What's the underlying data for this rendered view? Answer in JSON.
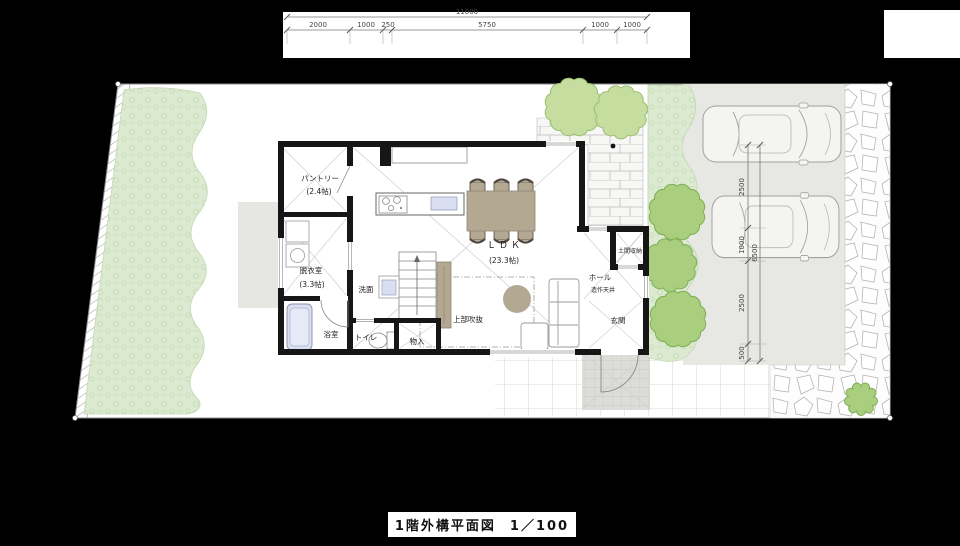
{
  "title": {
    "label": "1階外構平面図",
    "scale": "1／100"
  },
  "dims": {
    "top": {
      "total": "11000",
      "segments": [
        "2000",
        "1000",
        "250",
        "5750",
        "1000",
        "1000"
      ]
    },
    "right": {
      "total": "6500",
      "segments": [
        "2500",
        "1000",
        "2500",
        "500"
      ]
    }
  },
  "rooms": {
    "pantry": {
      "name": "パントリー",
      "size": "(2.4帖)"
    },
    "dressing_room": {
      "name": "脱衣室",
      "size": "(3.3帖)"
    },
    "washroom": {
      "name": "洗面"
    },
    "bathroom": {
      "name": "浴室"
    },
    "toilet": {
      "name": "トイレ"
    },
    "closet": {
      "name": "物入"
    },
    "void_above": {
      "name": "上部吹抜"
    },
    "ldk": {
      "name": "ＬＤＫ",
      "size": "(23.3帖)"
    },
    "doma_storage": {
      "name": "土間収納"
    },
    "hall": {
      "name": "ホール",
      "note": "造作天井"
    },
    "entrance": {
      "name": "玄関"
    }
  },
  "colors": {
    "background": "#000000",
    "site": "#ffffff",
    "planting_light": "#dcead2",
    "tree_light": "#c5dd9e",
    "tree_dark": "#a8ce7e",
    "parking": "#e7e7e4",
    "porch": "#dcdcd9",
    "furniture_tan": "#b3a993",
    "fixture_blue": "#d9def1",
    "wall": "#161616"
  }
}
